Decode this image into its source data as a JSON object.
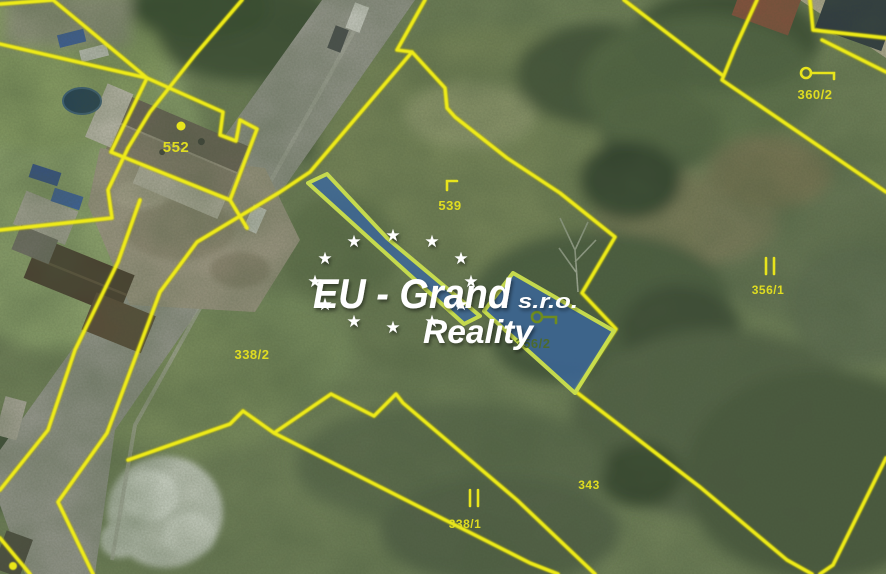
{
  "map": {
    "kind": "aerial-cadastral-map",
    "highlight_fill": "#3a66a0",
    "highlight_border": "#c9de4e",
    "boundary_color": "#f2ee1a",
    "label_color": "#e6e21f",
    "highlighted_parcel_label_color": "#4e6b24"
  },
  "parcels": [
    {
      "label": "552",
      "symbol": "boundary-dot",
      "highlighted": false
    },
    {
      "label": "539",
      "symbol": "corner-mark",
      "highlighted": false
    },
    {
      "label": "360/2",
      "symbol": "building-plot-symbol",
      "highlighted": false
    },
    {
      "label": "356/1",
      "symbol": "meadow-symbol",
      "highlighted": false
    },
    {
      "label": "356/2",
      "symbol": "building-plot-symbol",
      "highlighted": true
    },
    {
      "label": "338/2",
      "symbol": "",
      "highlighted": false
    },
    {
      "label": "343",
      "symbol": "",
      "highlighted": false
    },
    {
      "label": "338/1",
      "symbol": "meadow-symbol",
      "highlighted": false
    }
  ],
  "watermark": {
    "company": "EU - Grand",
    "legal_form": "s.r.o.",
    "line2": "Reality",
    "star": "★",
    "color": "#ffffff"
  }
}
